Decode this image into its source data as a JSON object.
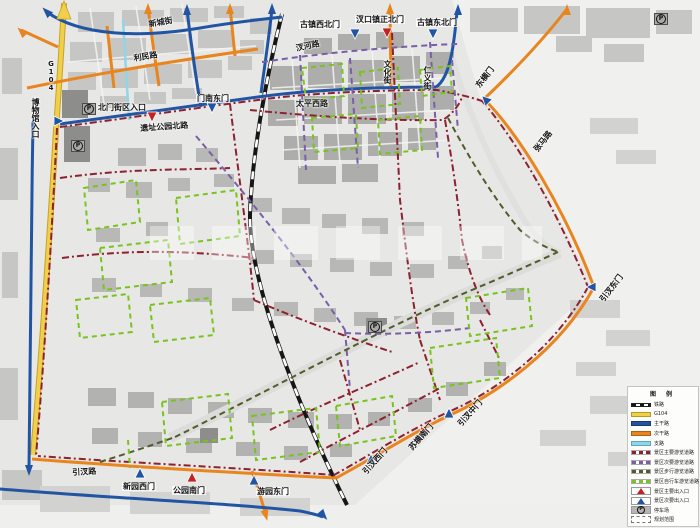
{
  "legend": {
    "title": "图 例",
    "items": [
      {
        "label": "铁路"
      },
      {
        "label": "G104"
      },
      {
        "label": "主干路"
      },
      {
        "label": "次干路"
      },
      {
        "label": "支路"
      },
      {
        "label": "景区主要游览道路"
      },
      {
        "label": "景区次要游览道路"
      },
      {
        "label": "景区步行游览道路"
      },
      {
        "label": "景区自行车游览道路"
      },
      {
        "label": "景区主要出入口"
      },
      {
        "label": "景区次要出入口"
      },
      {
        "label": "停车场"
      },
      {
        "label": "规划范围"
      }
    ],
    "colors": {
      "g104": "#f0cf4a",
      "main_road": "#2155a3",
      "secondary_road": "#e8851e",
      "branch_road": "#8fd6e6",
      "main_tour_route": "#8e2130",
      "secondary_tour_route": "#7a5fa8",
      "walk_tour_route": "#4f5d2a",
      "bike_tour_route": "#78c31d",
      "main_entrance": "#c32222",
      "secondary_entrance": "#2155a3"
    }
  },
  "streets": {
    "xincheng": "新城街",
    "limin": "利民路",
    "g104": "G104",
    "chahe": "汊河路",
    "wenhua": "文化街",
    "renyi": "仁义街",
    "taiping_west": "太平西路",
    "yizhi_park_north": "遗址公园北路",
    "yincha": "引汊路",
    "zhangma": "张马路"
  },
  "gates": {
    "museum_entrance": "博物馆入口",
    "north_block_entrance": "北门街区入口",
    "mennan_east": "门南东门",
    "old_town_northwest": "古镇西北门",
    "chakou_town_north": "汊口镇正北门",
    "old_town_northeast": "古镇东北门",
    "dongheng": "东横门",
    "yincha_east": "引汊东门",
    "yincha_middle": "引汊中门",
    "suheng_south": "苏横南门",
    "yincha_west": "引汊西门",
    "xinyuan_west": "新园西门",
    "park_south": "公园南门",
    "youyuan_east": "游园东门"
  },
  "icons": {
    "parking": "P"
  }
}
